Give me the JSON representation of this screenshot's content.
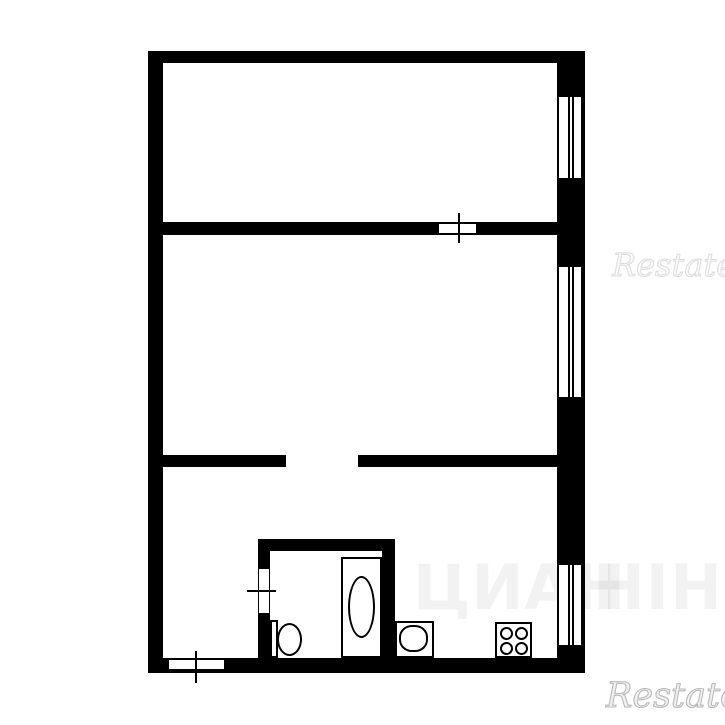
{
  "colors": {
    "background": "#ffffff",
    "walls": "#000000",
    "restate_watermark": "#c9c9c9",
    "center_watermark": "#000000"
  },
  "watermarks": {
    "restate_top": {
      "text": "Restate"
    },
    "restate_bottom": {
      "text": "Restate"
    },
    "center": {
      "left_fragment": "ЦИАН",
      "right_fragment": "НІН"
    }
  },
  "floorplan": {
    "kind": "black-and-white apartment floor plan, no text labels",
    "windows_count": 3,
    "opening_symbols_count": 3,
    "fixtures": [
      "bathtub",
      "toilet",
      "sink",
      "stove-4-burner"
    ]
  }
}
